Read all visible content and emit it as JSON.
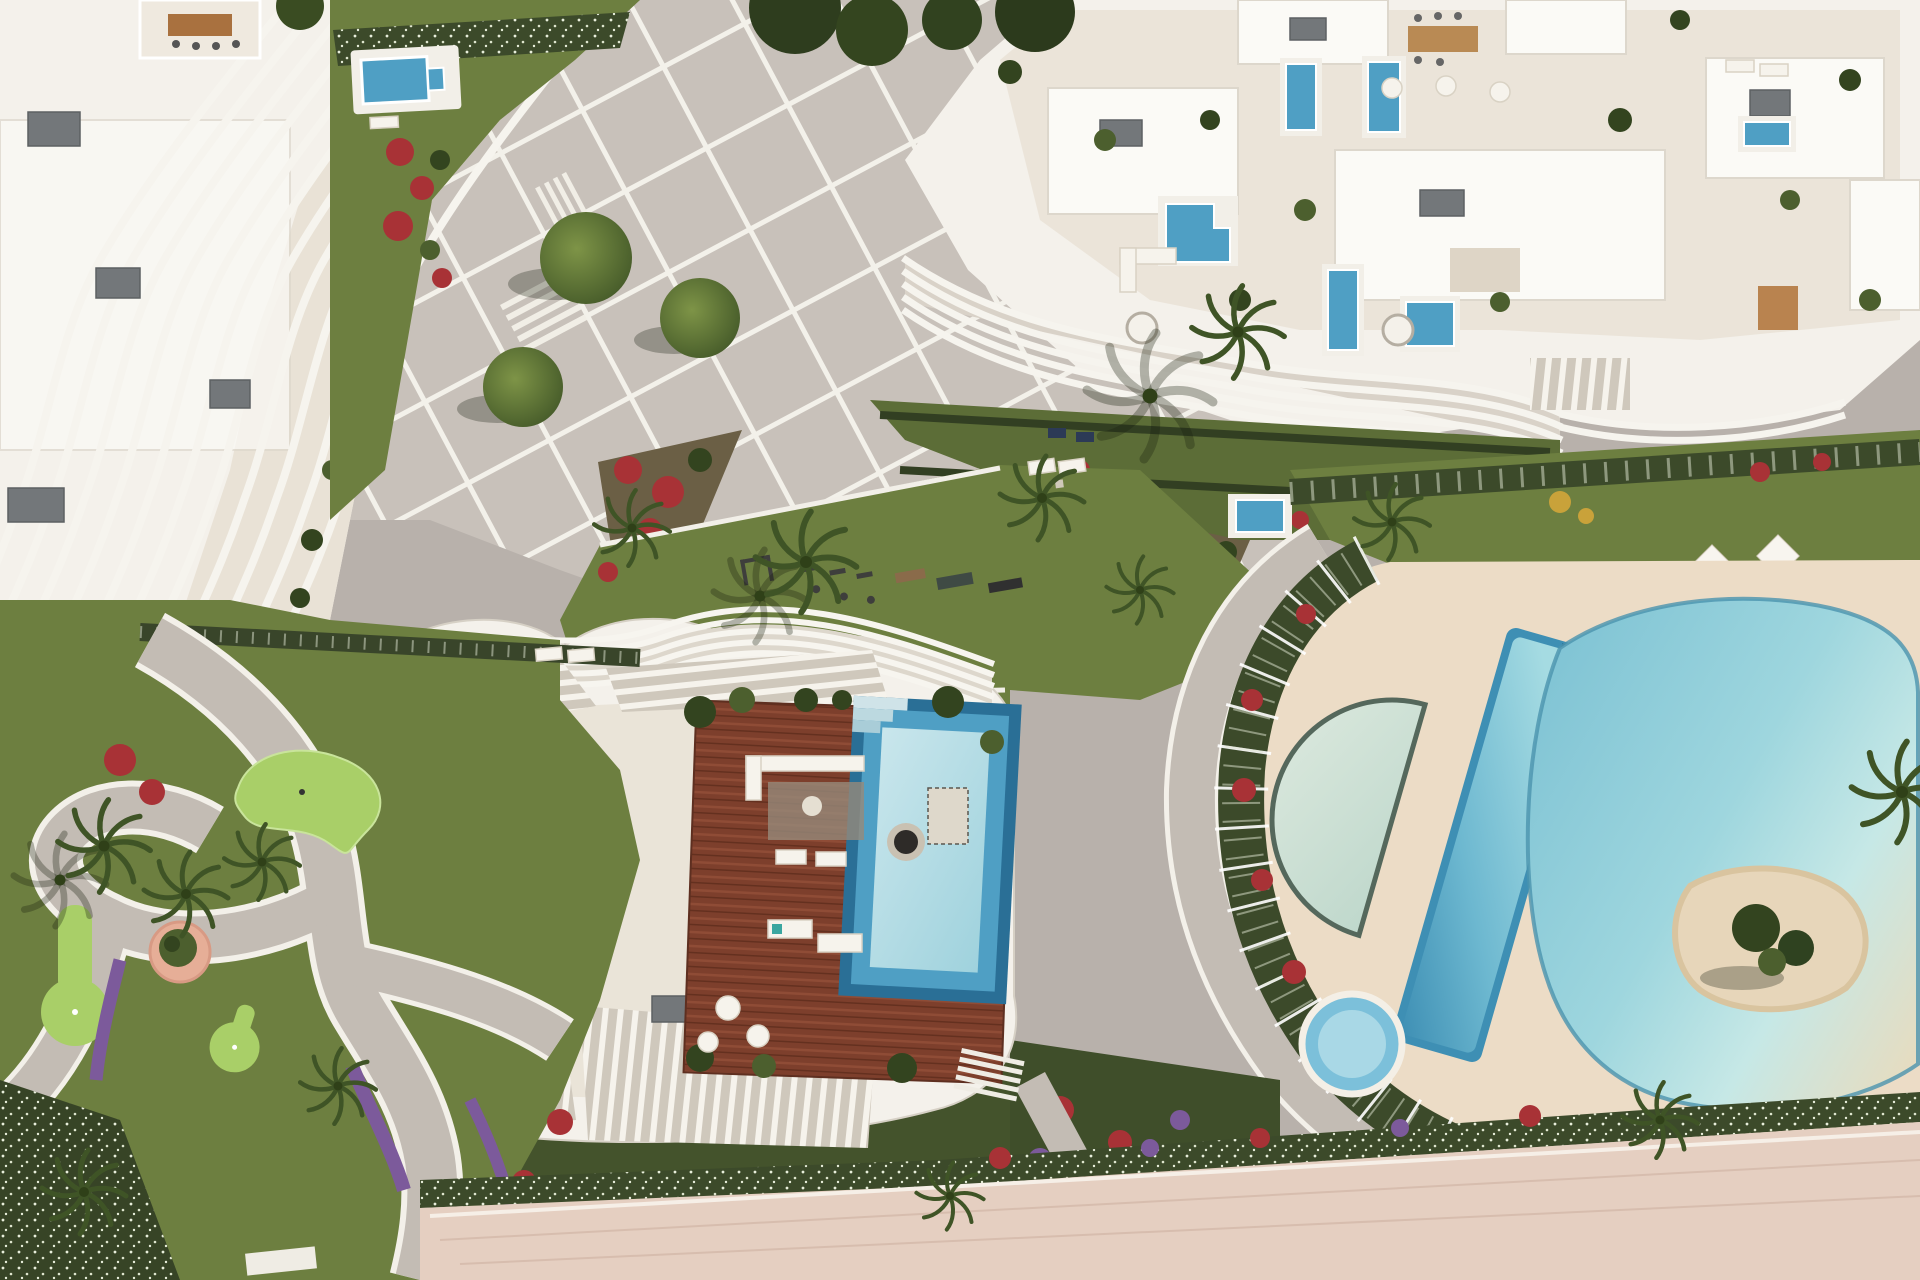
{
  "scene": {
    "type": "aerial-architectural-render",
    "description": "Top-down 3D rendering of a luxury coastal residential complex: three sculptural white apartment buildings with wavy louvered terraces, rooftop plunge pools and furniture; central diagonal-grid plaza with trees; communal pool complex with lap pool, half-moon pool, lagoon pool with sand island and kids pool; rooftop timber deck with large stepped pool; putting-green garden with winding paths; red and purple flower beds, palm trees and a pink beach promenade.",
    "regions": [
      {
        "id": "building-a",
        "label": "north-west building with curved vertical fins"
      },
      {
        "id": "plaza",
        "label": "central paved plaza with diagonal grid joints"
      },
      {
        "id": "building-b",
        "label": "north-east building with rooftop terraces and plunge pools"
      },
      {
        "id": "central-lawn",
        "label": "communal lawn with outdoor gym"
      },
      {
        "id": "pool-complex",
        "label": "lagoon pool complex with lap pool, half-moon pool, kids pool and sand island"
      },
      {
        "id": "building-c",
        "label": "south building with louvered pergolas, timber roof deck and stepped pool"
      },
      {
        "id": "minigolf-garden",
        "label": "putting-green garden with winding paths"
      },
      {
        "id": "promenade",
        "label": "pink beach promenade"
      }
    ]
  },
  "colors": {
    "paving_base": "#b8b1ab",
    "plaza_paving": "#c8c1ba",
    "joint_white": "#f3f1ea",
    "path_grey": "#c3bcb4",
    "road_grey": "#cfc9c2",
    "building_white": "#f4f1eb",
    "roof_white": "#fbfaf6",
    "terrace_beige": "#e9e2d6",
    "lawn_green": "#6d7f40",
    "lawn_dark": "#5c6d37",
    "putting_green": "#a9cf68",
    "hedge_dark": "#3c4a2a",
    "flower_red": "#a83236",
    "flower_purple": "#7c5a9b",
    "flower_yellow": "#c9a23a",
    "pool_blue": "#4f9fc4",
    "pool_deep": "#2a6f96",
    "pool_pale": "#c6e5ea",
    "lagoon_aqua": "#9fd3dc",
    "sand_beige": "#e7d6ba",
    "deck_cream": "#ecdcc6",
    "wood_deck": "#7d3f2c",
    "promenade_pink": "#e5cfc1",
    "umbrella_white": "#f8f5ef",
    "teal_rug": "#3aa6a0",
    "planter_pink": "#e6ae97",
    "ac_grey": "#73777a",
    "gym_dark": "#3e3e3c"
  }
}
